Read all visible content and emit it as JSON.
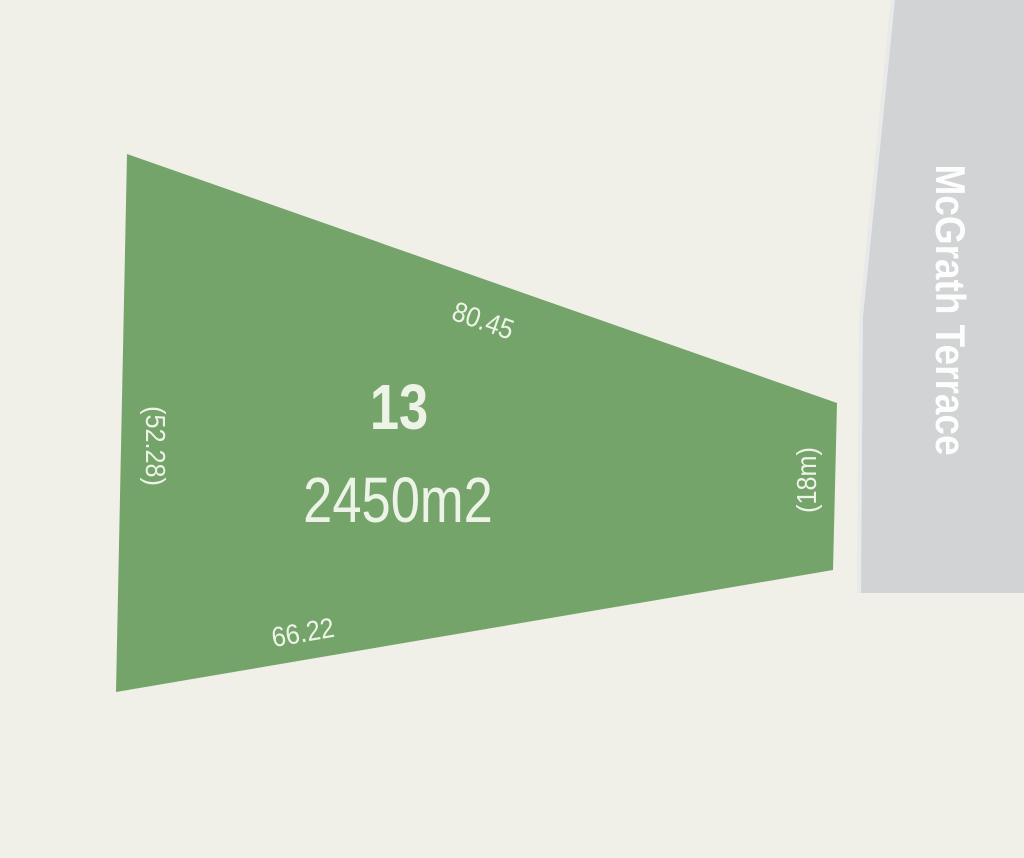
{
  "colors": {
    "background": "#f0efe8",
    "lot_fill": "#74a46a",
    "road_fill": "#d1d3d4",
    "road_edge": "#e7eae8",
    "lot_text": "#eef3e8",
    "street_text": "#fcfdfc"
  },
  "lot": {
    "number": "13",
    "area": "2450m2",
    "dimensions": {
      "top": "80.45",
      "bottom": "66.22",
      "left": "(52.28)",
      "right": "(18m)"
    }
  },
  "street": {
    "name": "McGrath Terrace"
  }
}
